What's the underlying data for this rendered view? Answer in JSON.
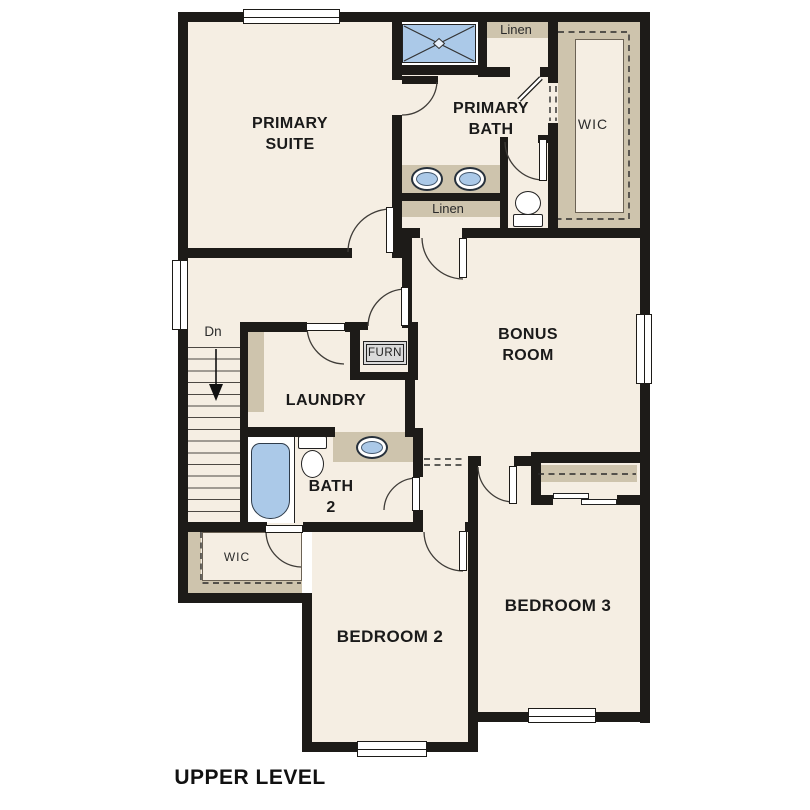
{
  "title": "UPPER LEVEL",
  "colors": {
    "floor": "#f5eee3",
    "wall": "#1d1b18",
    "shelf_tan": "#cec4ad",
    "fixture_blue": "#abc9e8",
    "line": "#3f3c38"
  },
  "rooms": {
    "primary_suite": {
      "line1": "PRIMARY",
      "line2": "SUITE"
    },
    "primary_bath": {
      "line1": "PRIMARY",
      "line2": "BATH"
    },
    "bonus_room": {
      "line1": "BONUS",
      "line2": "ROOM"
    },
    "laundry": {
      "label": "LAUNDRY"
    },
    "bath2": {
      "line1": "BATH",
      "line2": "2"
    },
    "bedroom2": {
      "label": "BEDROOM 2"
    },
    "bedroom3": {
      "label": "BEDROOM 3"
    }
  },
  "closets": {
    "wic_upper": "WIC",
    "wic_lower": "WIC",
    "linen_upper": "Linen",
    "linen_hall": "Linen"
  },
  "annotations": {
    "stairs_down": "Dn",
    "furnace": "FURN"
  }
}
